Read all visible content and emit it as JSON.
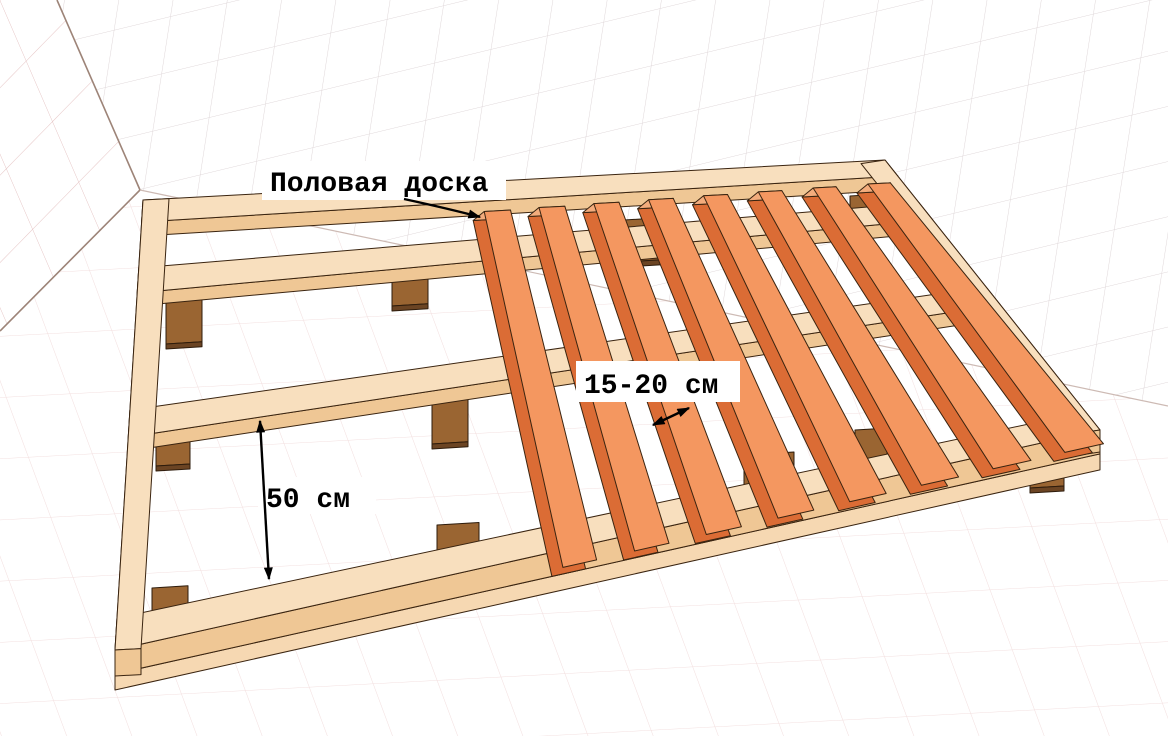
{
  "annotations": {
    "floorboard_label": "Половая доска",
    "board_gap_label": "15-20 см",
    "joist_gap_label": "50 см"
  },
  "colors": {
    "background": "#FFFFFF",
    "outline": "#3A2410",
    "joist_top": "#F8DFBE",
    "joist_front": "#EFC795",
    "joist_front_light": "#F6D8B2",
    "board_top": "#F49760",
    "board_side": "#DB6C35",
    "board_end": "#F3AC7C",
    "block_front": "#9A6532",
    "block_dark": "#6B4423",
    "block_outline": "#2E1C0C",
    "grid_left_wall": "#E5C4C4",
    "grid_back_wall": "#DFD7D9",
    "grid_floor": "#F2DEDE",
    "wall_edge": "#9D8478",
    "wall_edge_light": "#CDBAB4",
    "annotation": "#000000"
  }
}
